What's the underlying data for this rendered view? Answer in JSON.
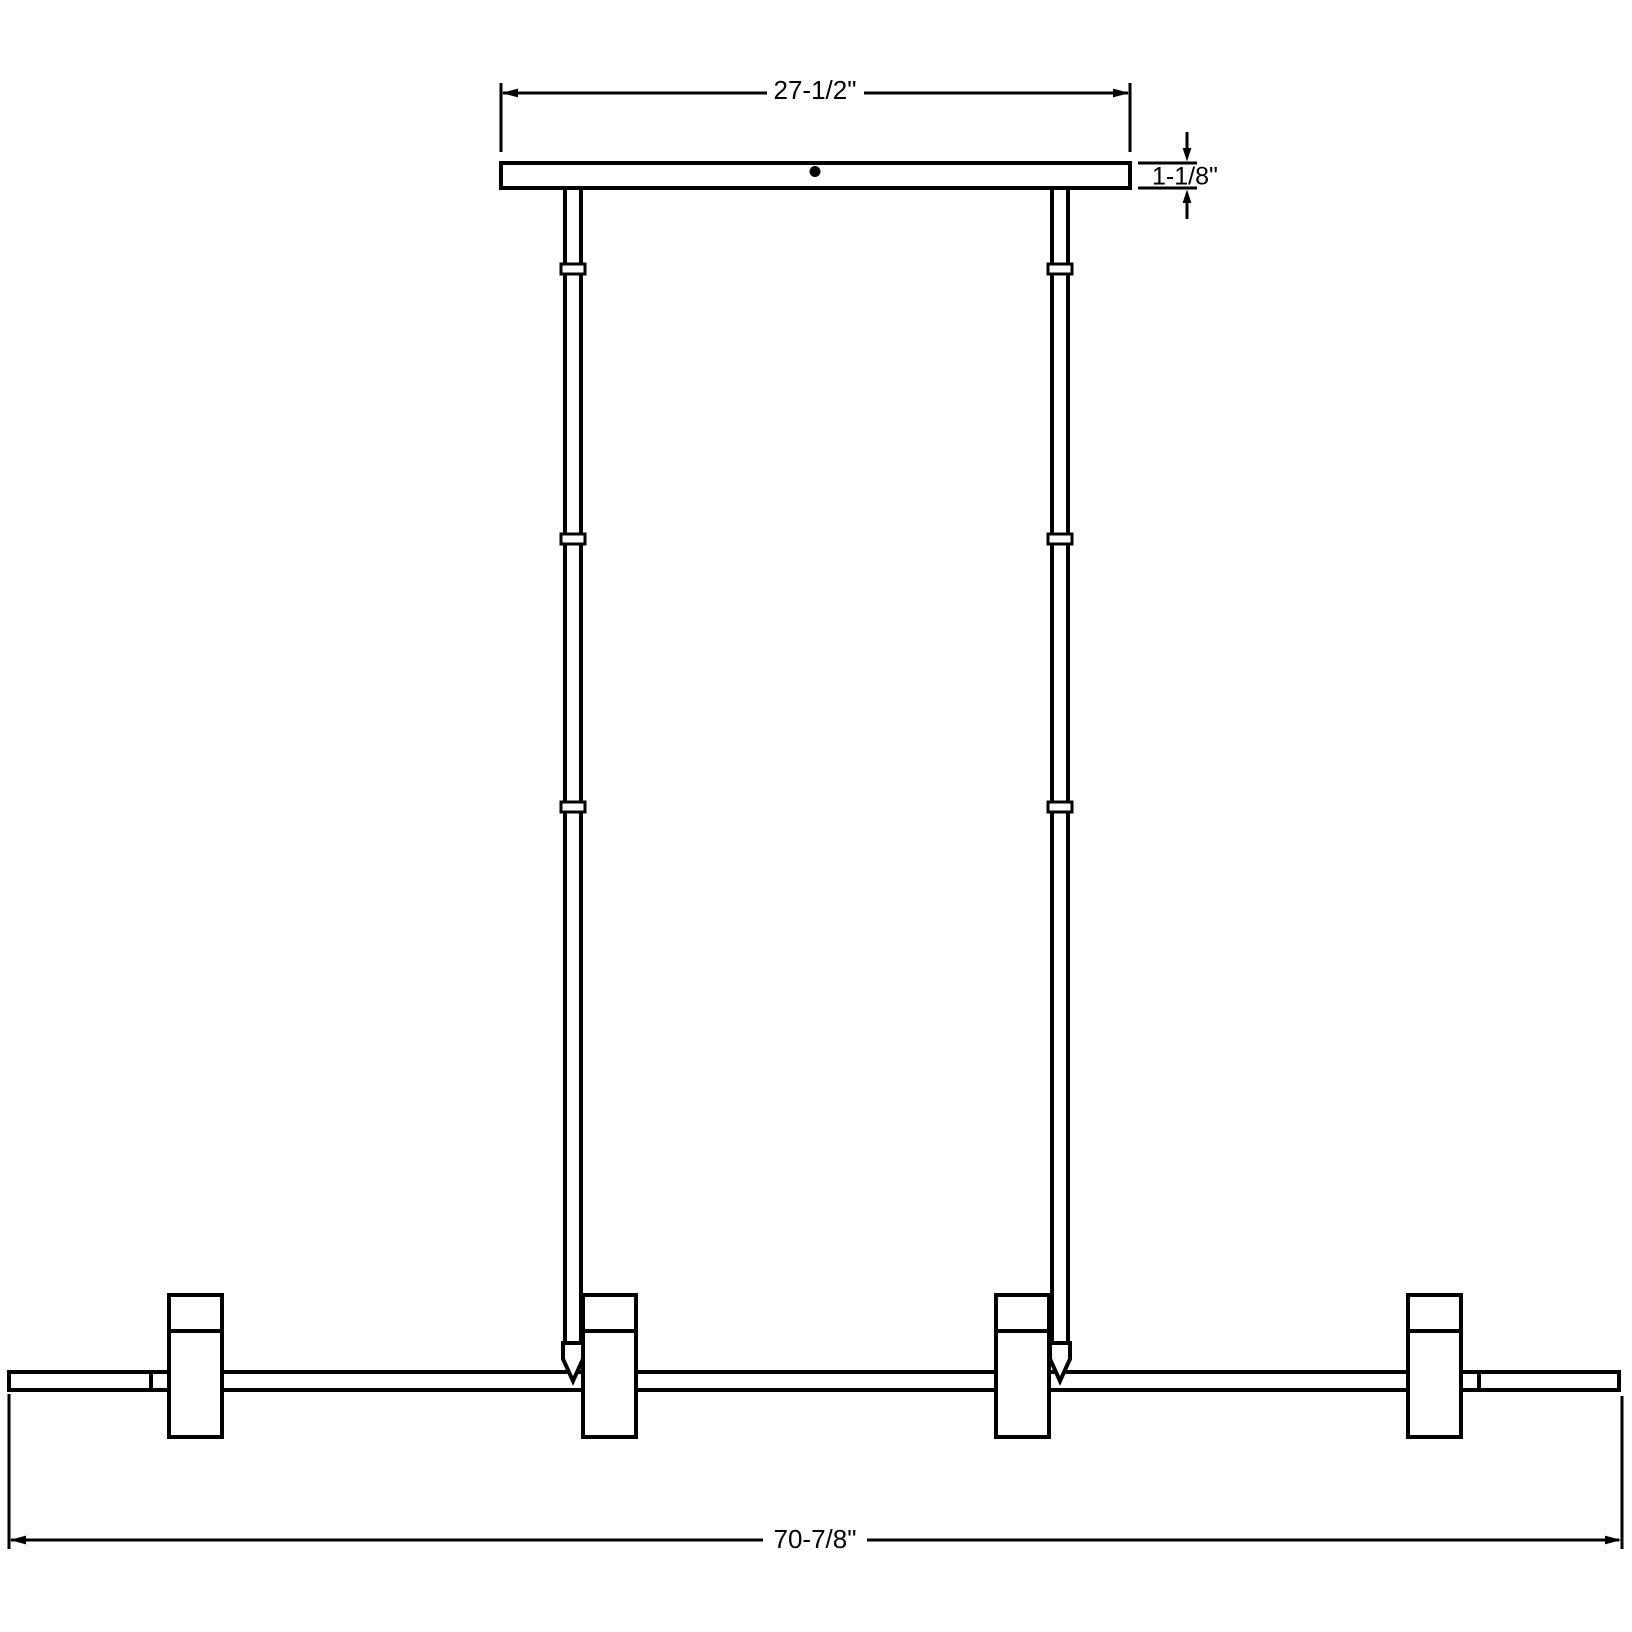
{
  "page": {
    "background_color": "#ffffff"
  },
  "drawing": {
    "kind": "pendant-fixture-dimension-drawing",
    "line_color": "#000000",
    "canopy": {
      "width_label": "27-1/2\"",
      "thickness_label": "1-1/8\""
    },
    "stems": {
      "count": 2,
      "couplers_per_stem": 3
    },
    "bar": {
      "length_label": "70-7/8\"",
      "segment_seams": 2
    },
    "heads": {
      "count": 4
    }
  }
}
